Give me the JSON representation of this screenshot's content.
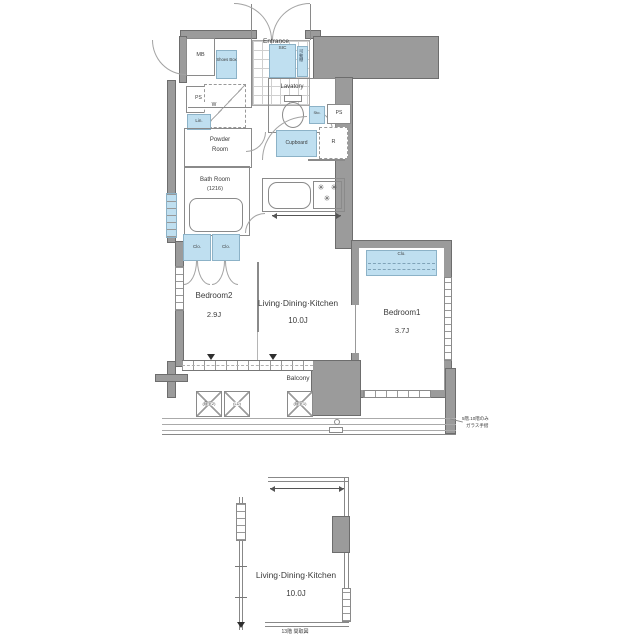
{
  "colors": {
    "wall_fill": "#9b9b9b",
    "wall_border": "#6d6d6d",
    "fixture_blue": "#bfdff0",
    "line_gray": "#8a8a8a",
    "text": "#3b3b3b"
  },
  "main_plan": {
    "rooms": {
      "bedroom2": {
        "name": "Bedroom2",
        "size": "2.9J"
      },
      "ldk": {
        "name": "Living·Dining·Kitchen",
        "size": "10.0J"
      },
      "bedroom1": {
        "name": "Bedroom1",
        "size": "3.7J"
      },
      "balcony": {
        "name": "Balcony"
      },
      "entrance": {
        "name": "Entrance"
      },
      "lavatory": {
        "name": "Lavatory"
      },
      "powder_room": {
        "line1": "Powder",
        "line2": "Room"
      },
      "bath_room": {
        "name": "Bath Room",
        "size": "(1216)"
      }
    },
    "fixtures": {
      "mb": "MB",
      "shoes_box": "Shoes Box",
      "sic": "SIC",
      "movable_shelf": "可動棚",
      "ps_left": "PS",
      "washer": "W",
      "linen": "Lin.",
      "storage": "Sto.",
      "ps_right": "PS",
      "cupboard": "Cupboard",
      "refrigerator": "R",
      "closet": "Clo."
    },
    "balcony_units": [
      "(寝室2)",
      "(LD)",
      "(寝室1)"
    ],
    "note": {
      "line1": "5階.10階のみ",
      "line2": "ガラス手摺"
    }
  },
  "lower_plan": {
    "ldk": {
      "name": "Living·Dining·Kitchen",
      "size": "10.0J"
    },
    "caption": "13階 間取図"
  },
  "icons": {
    "stove_burner": "✳"
  }
}
